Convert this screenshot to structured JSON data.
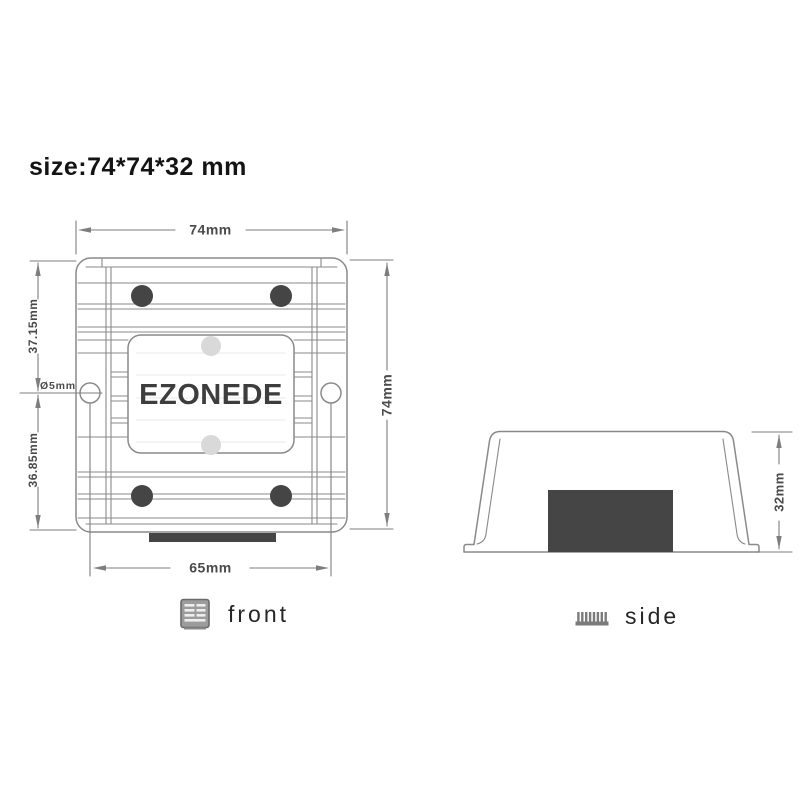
{
  "title": "size:74*74*32 mm",
  "front_view": {
    "brand": "EZONEDE",
    "caption": "front",
    "dim_width": "74mm",
    "dim_height": "74mm",
    "dim_top_to_hole": "37.15mm",
    "dim_hole_to_bottom": "36.85mm",
    "dim_hole": "Ø5mm",
    "dim_mount_spacing": "65mm"
  },
  "side_view": {
    "caption": "side",
    "dim_height": "32mm"
  },
  "icons": {
    "front_icon": "heatsink-front-icon",
    "side_icon": "heatsink-side-icon"
  },
  "colors": {
    "line": "#8a8a8a",
    "dim_line": "#7e7e7e",
    "dim_text": "#4a4a4a",
    "dark_fill": "#454545",
    "light_fill": "#d9d9d9",
    "title_text": "#141414",
    "caption_text": "#262626",
    "brand_text": "#3d3d3d"
  }
}
